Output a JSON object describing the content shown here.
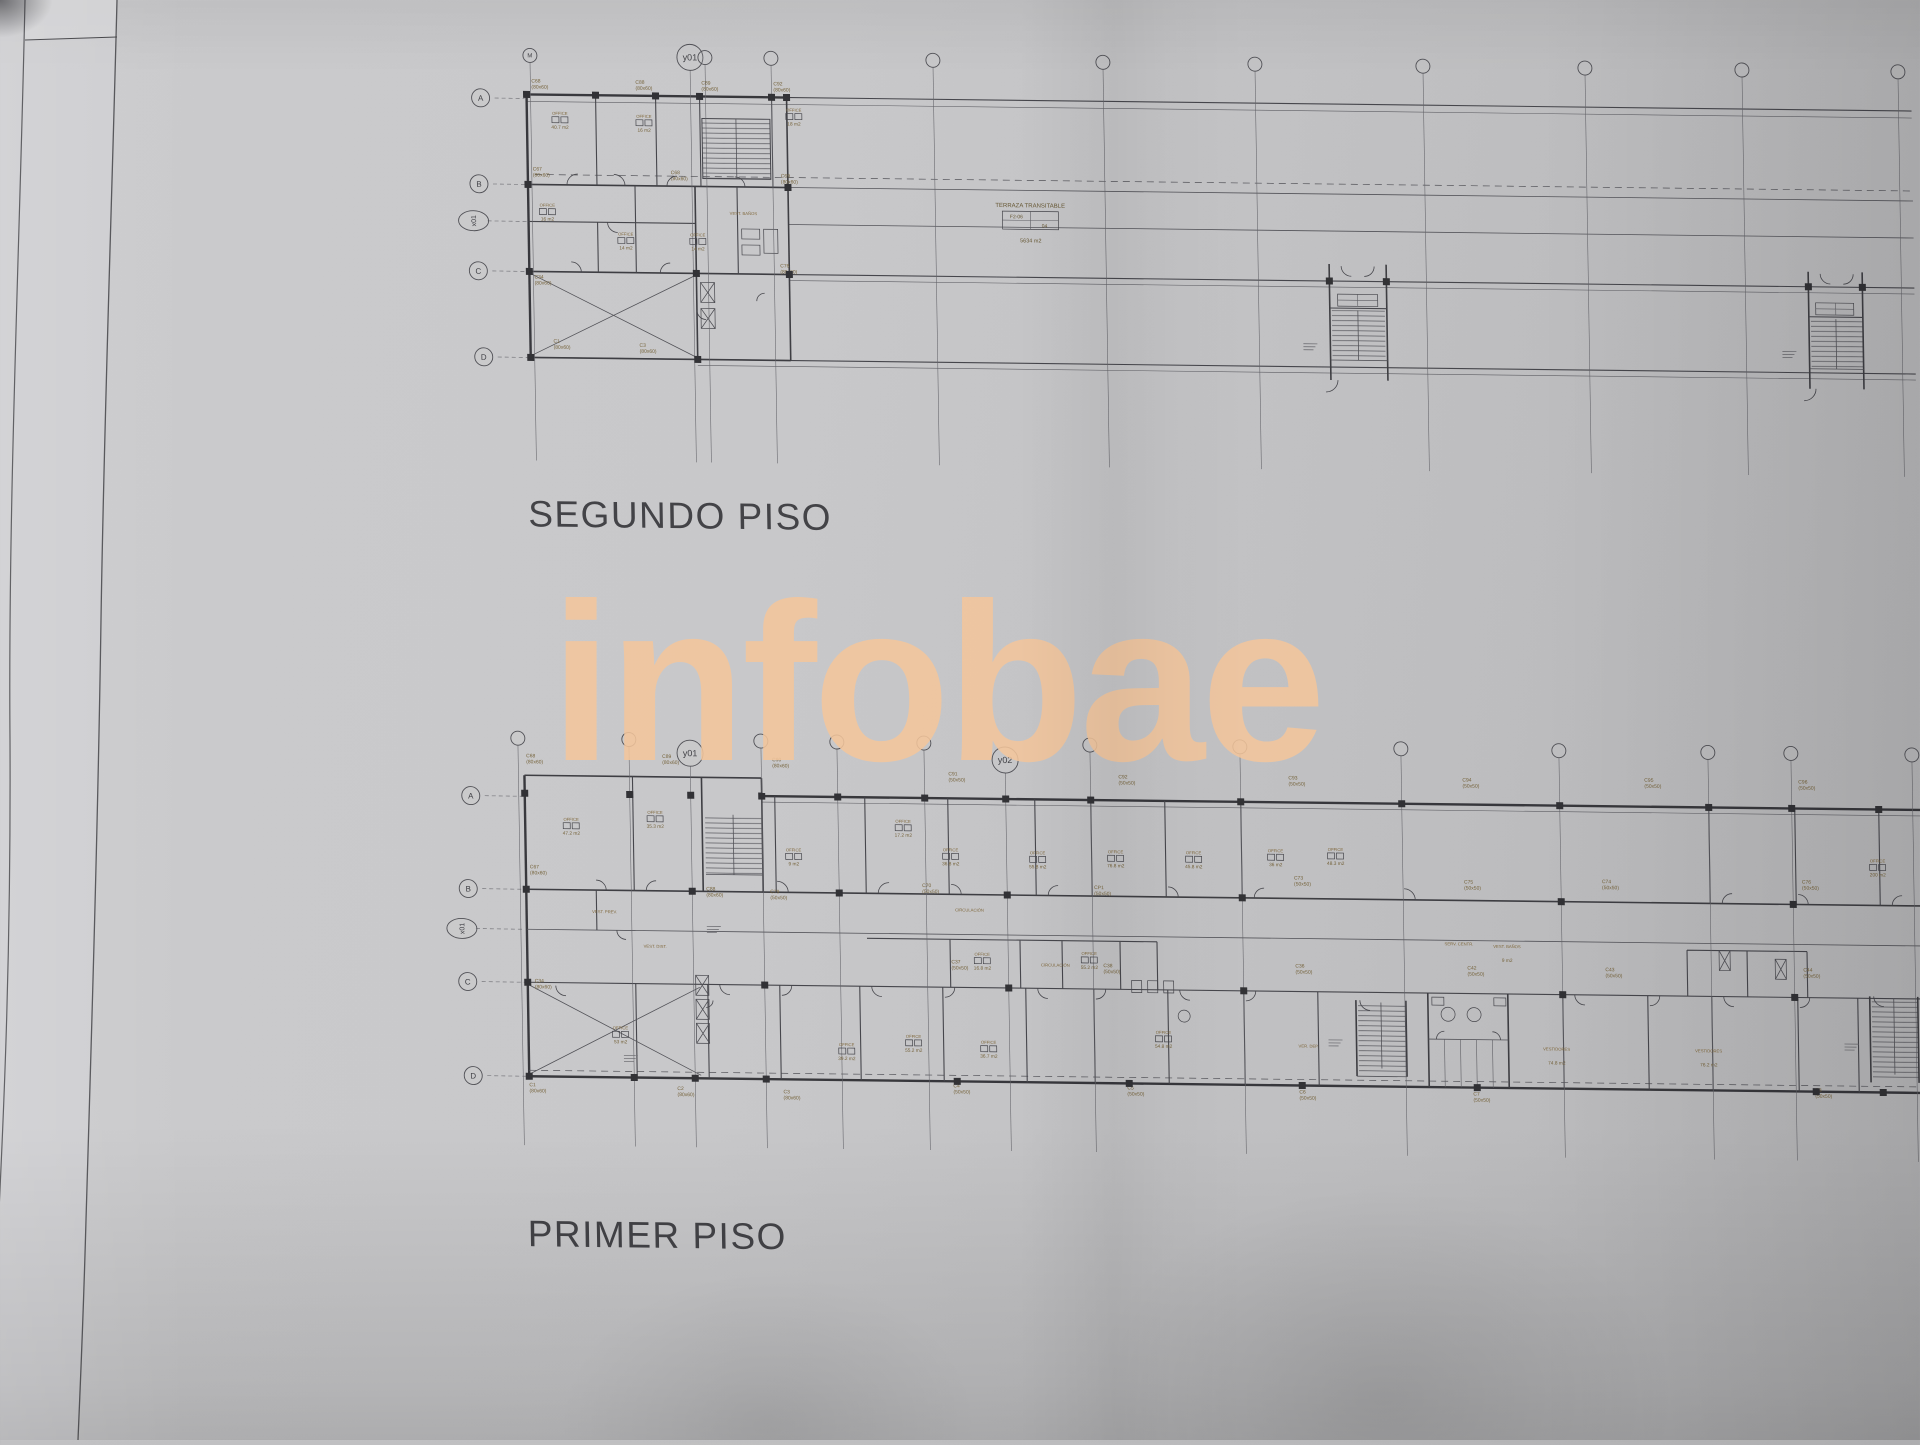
{
  "titles": {
    "segundo": "SEGUNDO PISO",
    "primer": "PRIMER PISO"
  },
  "watermark": {
    "text": "infobae",
    "color": "#f4c69c"
  },
  "colors": {
    "paper": "#c6c6c8",
    "ink": "#3c3c42",
    "tag_ink": "#6e5a2e",
    "title_ink": "#38383c",
    "watermark": "#f4c69c"
  },
  "terraza": {
    "title": "TERRAZA TRANSITABLE",
    "cell_code": "F2-06",
    "cell_num": "04",
    "area": "5634 m2"
  },
  "segundo": {
    "grid_top": [
      {
        "x": 537,
        "label": "M",
        "big": false
      },
      {
        "x": 697,
        "label": "y01",
        "big": true
      },
      {
        "x": 712,
        "label": "",
        "big": false
      },
      {
        "x": 778,
        "label": "",
        "big": false
      },
      {
        "x": 940,
        "label": "",
        "big": false
      },
      {
        "x": 1110,
        "label": "",
        "big": false
      },
      {
        "x": 1262,
        "label": "",
        "big": false
      },
      {
        "x": 1430,
        "label": "",
        "big": false
      },
      {
        "x": 1592,
        "label": "",
        "big": false
      },
      {
        "x": 1749,
        "label": "",
        "big": false
      },
      {
        "x": 1905,
        "label": "",
        "big": false
      }
    ],
    "grid_left": [
      {
        "x": 487,
        "y": 100,
        "label": "A",
        "oval": false
      },
      {
        "x": 484,
        "y": 186,
        "label": "B",
        "oval": false
      },
      {
        "x": 478,
        "y": 223,
        "label": "x01",
        "oval": true
      },
      {
        "x": 482,
        "y": 273,
        "label": "C",
        "oval": false
      },
      {
        "x": 486,
        "y": 359,
        "label": "D",
        "oval": false
      }
    ],
    "col_tags": [
      {
        "x": 538,
        "y": 84,
        "name": "C68",
        "size": "(80x60)"
      },
      {
        "x": 642,
        "y": 84,
        "name": "C88",
        "size": "(80x60)"
      },
      {
        "x": 708,
        "y": 84,
        "name": "C89",
        "size": "(80x60)"
      },
      {
        "x": 780,
        "y": 84,
        "name": "C92",
        "size": "(80x60)"
      },
      {
        "x": 538,
        "y": 172,
        "name": "C67",
        "size": "(80x60)"
      },
      {
        "x": 676,
        "y": 174,
        "name": "C68",
        "size": "(80x60)"
      },
      {
        "x": 786,
        "y": 176,
        "name": "C69",
        "size": "(80x60)"
      },
      {
        "x": 538,
        "y": 280,
        "name": "C34",
        "size": "(80x60)"
      },
      {
        "x": 784,
        "y": 266,
        "name": "C76",
        "size": "(80x60)"
      },
      {
        "x": 556,
        "y": 344,
        "name": "C1",
        "size": "(80x60)"
      },
      {
        "x": 642,
        "y": 347,
        "name": "C3",
        "size": "(80x60)"
      }
    ],
    "offices": [
      {
        "x": 566,
        "y": 116,
        "label": "OFFICE",
        "area": "40.7 m2"
      },
      {
        "x": 650,
        "y": 118,
        "label": "OFFICE",
        "area": "16 m2"
      },
      {
        "x": 800,
        "y": 110,
        "label": "OFFICE",
        "area": "18 m2"
      },
      {
        "x": 552,
        "y": 208,
        "label": "OFFICE",
        "area": "16 m2"
      },
      {
        "x": 630,
        "y": 236,
        "label": "OFFICE",
        "area": "14 m2"
      },
      {
        "x": 702,
        "y": 236,
        "label": "OFFICE",
        "area": "14 m2"
      },
      {
        "x": 748,
        "y": 214,
        "label": "VEST. BAÑOS",
        "area": ""
      }
    ]
  },
  "primer": {
    "grid_top": [
      {
        "x": 514,
        "y": 740,
        "label": "",
        "big": false
      },
      {
        "x": 625,
        "y": 740,
        "label": "",
        "big": false
      },
      {
        "x": 686,
        "y": 753,
        "label": "y01",
        "big": true
      },
      {
        "x": 757,
        "y": 740,
        "label": "",
        "big": false
      },
      {
        "x": 833,
        "y": 740,
        "label": "",
        "big": false
      },
      {
        "x": 920,
        "y": 740,
        "label": "",
        "big": false
      },
      {
        "x": 1001,
        "y": 756,
        "label": "y02",
        "big": true
      },
      {
        "x": 1086,
        "y": 740,
        "label": "",
        "big": false
      },
      {
        "x": 1236,
        "y": 740,
        "label": "",
        "big": false
      },
      {
        "x": 1397,
        "y": 740,
        "label": "",
        "big": false
      },
      {
        "x": 1555,
        "y": 740,
        "label": "",
        "big": false
      },
      {
        "x": 1704,
        "y": 740,
        "label": "",
        "big": false
      },
      {
        "x": 1787,
        "y": 740,
        "label": "",
        "big": false
      },
      {
        "x": 1908,
        "y": 740,
        "label": "",
        "big": false
      }
    ],
    "grid_left": [
      {
        "x": 466,
        "y": 798,
        "label": "A",
        "oval": false
      },
      {
        "x": 462,
        "y": 891,
        "label": "B",
        "oval": false
      },
      {
        "x": 455,
        "y": 931,
        "label": "x01",
        "oval": true
      },
      {
        "x": 460,
        "y": 984,
        "label": "C",
        "oval": false
      },
      {
        "x": 464,
        "y": 1078,
        "label": "D",
        "oval": false
      }
    ],
    "col_tags": [
      {
        "x": 522,
        "y": 759,
        "name": "C68",
        "size": "(80x60)"
      },
      {
        "x": 658,
        "y": 758,
        "name": "C89",
        "size": "(80x60)"
      },
      {
        "x": 768,
        "y": 760,
        "name": "C90",
        "size": "(80x60)"
      },
      {
        "x": 944,
        "y": 772,
        "name": "C91",
        "size": "(50x50)"
      },
      {
        "x": 1114,
        "y": 773,
        "name": "C92",
        "size": "(50x50)"
      },
      {
        "x": 1284,
        "y": 772,
        "name": "C93",
        "size": "(50x50)"
      },
      {
        "x": 1458,
        "y": 772,
        "name": "C94",
        "size": "(50x50)"
      },
      {
        "x": 1640,
        "y": 770,
        "name": "C95",
        "size": "(50x50)"
      },
      {
        "x": 1794,
        "y": 770,
        "name": "C96",
        "size": "(50x50)"
      },
      {
        "x": 524,
        "y": 870,
        "name": "C67",
        "size": "(80x60)"
      },
      {
        "x": 700,
        "y": 890,
        "name": "C88",
        "size": "(80x60)"
      },
      {
        "x": 764,
        "y": 892,
        "name": "C79",
        "size": "(50x50)"
      },
      {
        "x": 916,
        "y": 884,
        "name": "C70",
        "size": "(50x50)"
      },
      {
        "x": 1088,
        "y": 884,
        "name": "CP1",
        "size": "(50x50)"
      },
      {
        "x": 1288,
        "y": 872,
        "name": "C73",
        "size": "(50x50)"
      },
      {
        "x": 1458,
        "y": 874,
        "name": "C75",
        "size": "(50x50)"
      },
      {
        "x": 1596,
        "y": 872,
        "name": "C74",
        "size": "(50x50)"
      },
      {
        "x": 1796,
        "y": 870,
        "name": "C76",
        "size": "(50x50)"
      },
      {
        "x": 527,
        "y": 984,
        "name": "C34",
        "size": "(80x60)"
      },
      {
        "x": 944,
        "y": 960,
        "name": "C37",
        "size": "(50x50)"
      },
      {
        "x": 1096,
        "y": 962,
        "name": "C38",
        "size": "(50x50)"
      },
      {
        "x": 1288,
        "y": 960,
        "name": "C36",
        "size": "(50x50)"
      },
      {
        "x": 1460,
        "y": 960,
        "name": "C42",
        "size": "(50x50)"
      },
      {
        "x": 1598,
        "y": 960,
        "name": "C43",
        "size": "(50x50)"
      },
      {
        "x": 1796,
        "y": 958,
        "name": "C44",
        "size": "(50x50)"
      },
      {
        "x": 520,
        "y": 1088,
        "name": "C1",
        "size": "(80x60)"
      },
      {
        "x": 668,
        "y": 1090,
        "name": "C2",
        "size": "(80x60)"
      },
      {
        "x": 774,
        "y": 1092,
        "name": "C3",
        "size": "(80x60)"
      },
      {
        "x": 944,
        "y": 1084,
        "name": "C4",
        "size": "(50x50)"
      },
      {
        "x": 1118,
        "y": 1084,
        "name": "C5",
        "size": "(50x50)"
      },
      {
        "x": 1290,
        "y": 1086,
        "name": "C6",
        "size": "(50x50)"
      },
      {
        "x": 1464,
        "y": 1086,
        "name": "C7",
        "size": "(50x50)"
      },
      {
        "x": 1806,
        "y": 1078,
        "name": "C8",
        "size": "(50x50)"
      }
    ],
    "offices": [
      {
        "x": 566,
        "y": 822,
        "label": "OFFICE",
        "area": "47.2 m2"
      },
      {
        "x": 650,
        "y": 814,
        "label": "OFFICE",
        "area": "35.3 m2"
      },
      {
        "x": 788,
        "y": 850,
        "label": "OFFICE",
        "area": "9 m2"
      },
      {
        "x": 898,
        "y": 820,
        "label": "OFFICE",
        "area": "17.2 m2"
      },
      {
        "x": 945,
        "y": 848,
        "label": "OFFICE",
        "area": "36.8 m2"
      },
      {
        "x": 1032,
        "y": 850,
        "label": "OFFICE",
        "area": "55.8 m2"
      },
      {
        "x": 1110,
        "y": 848,
        "label": "OFFICE",
        "area": "76.8 m2"
      },
      {
        "x": 1188,
        "y": 848,
        "label": "OFFICE",
        "area": "45.8 m2"
      },
      {
        "x": 1270,
        "y": 845,
        "label": "OFFICE",
        "area": "36 m2"
      },
      {
        "x": 1330,
        "y": 843,
        "label": "OFFICE",
        "area": "48.3 m2"
      },
      {
        "x": 1872,
        "y": 848,
        "label": "OFFICE",
        "area": "200 m2"
      },
      {
        "x": 963,
        "y": 908,
        "label": "CIRCULACIÓN",
        "area": ""
      },
      {
        "x": 598,
        "y": 914,
        "label": "VEST. PREV.",
        "area": ""
      },
      {
        "x": 648,
        "y": 948,
        "label": "VEST. DIST.",
        "area": ""
      },
      {
        "x": 975,
        "y": 952,
        "label": "OFFICE",
        "area": "16.8 m2"
      },
      {
        "x": 1082,
        "y": 950,
        "label": "OFFICE",
        "area": "55.2 m2"
      },
      {
        "x": 1452,
        "y": 936,
        "label": "SERV. CENTR.",
        "area": ""
      },
      {
        "x": 1500,
        "y": 938,
        "label": "VEST. BAÑOS",
        "area": "9 m2"
      },
      {
        "x": 1048,
        "y": 962,
        "label": "CIRCULACIÓN",
        "area": ""
      },
      {
        "x": 612,
        "y": 1030,
        "label": "OFFICE",
        "area": "53 m2"
      },
      {
        "x": 838,
        "y": 1044,
        "label": "OFFICE",
        "area": "39.2 m2"
      },
      {
        "x": 905,
        "y": 1035,
        "label": "OFFICE",
        "area": "55.2 m2"
      },
      {
        "x": 980,
        "y": 1040,
        "label": "OFFICE",
        "area": "36.7 m2"
      },
      {
        "x": 1155,
        "y": 1028,
        "label": "OFFICE",
        "area": "54.8 m2"
      },
      {
        "x": 1300,
        "y": 1040,
        "label": "VER. DEP.",
        "area": ""
      },
      {
        "x": 1548,
        "y": 1040,
        "label": "VESTIDORES",
        "area": "74.8 m2"
      },
      {
        "x": 1700,
        "y": 1040,
        "label": "VESTIDORES",
        "area": "76.2 m2"
      }
    ]
  }
}
